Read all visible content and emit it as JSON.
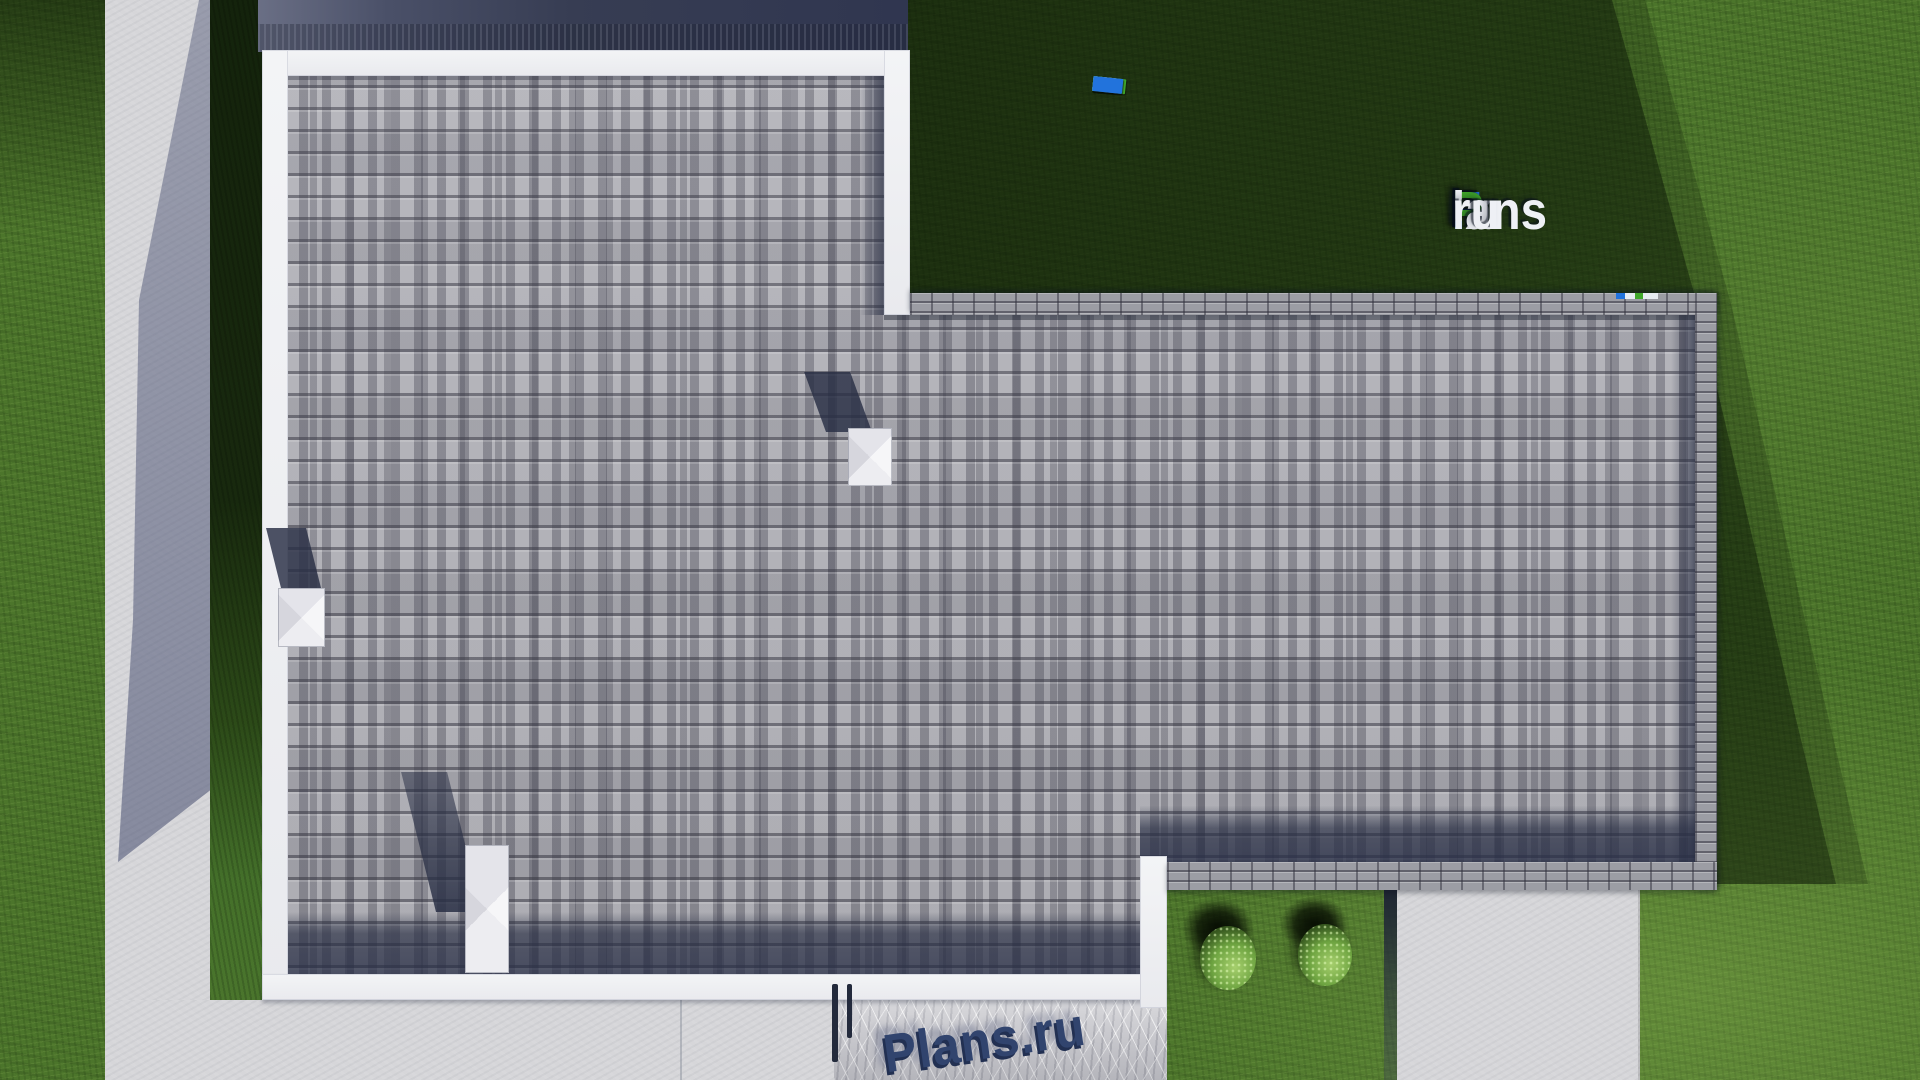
{
  "watermark": {
    "logo": {
      "f": "F",
      "ix": "ix",
      "p": "P",
      "lans": "lans",
      "dot": ".",
      "ru": "ru"
    },
    "logo_full": "FixPlans.ru",
    "ground_text": "Plans.ru"
  },
  "colors": {
    "brand_blue": "#2273dc",
    "brand_green": "#41a82b",
    "logo_white": "#eef0f5",
    "text_navy": "#31446e",
    "grass": "#4c752b",
    "grass_shadow": "#16260c",
    "concrete": "#d6d6d9",
    "roof_light": "#b0b0b7",
    "roof_shadow_navy": "#2e3449",
    "parapet_white": "#eef0f2",
    "parapet_brick": "#9c9da4"
  }
}
